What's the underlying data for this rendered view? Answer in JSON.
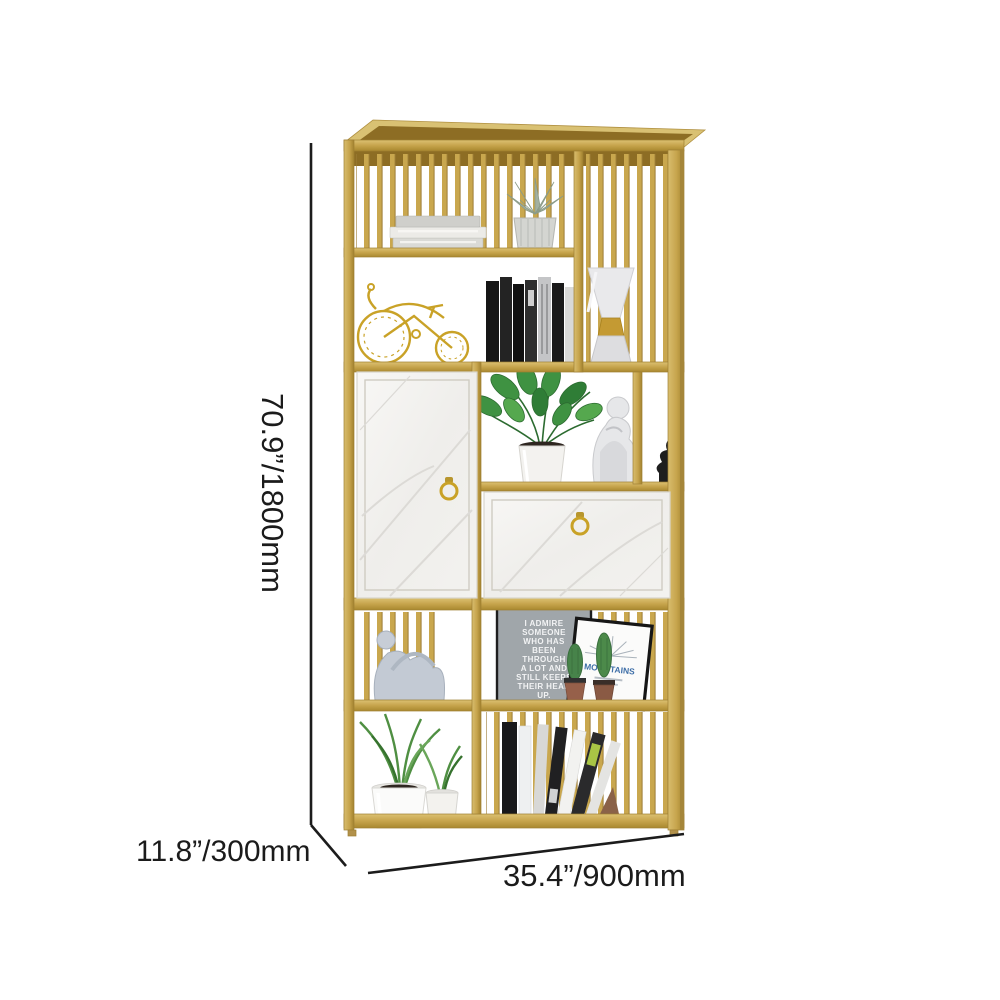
{
  "image": {
    "type": "furniture-dimension-diagram",
    "product_name": "Gold metal etagere bookshelf with white marble cabinet doors",
    "background": "#ffffff"
  },
  "dimensions": {
    "height": "70.9”/1800mm",
    "depth": "11.8”/300mm",
    "width": "35.4”/900mm"
  },
  "decor": {
    "quote_print_lines": [
      "I ADMIRE",
      "SOMEONE",
      "WHO HAS",
      "BEEN",
      "THROUGH",
      "A LOT AND",
      "STILL KEEPS",
      "THEIR HEAD",
      "UP."
    ],
    "mountains_print_text": "MOUNTAINS"
  },
  "colors": {
    "frame_gold": "#c6a44c",
    "frame_gold_dark": "#8d6d24",
    "frame_gold_light": "#dcc172",
    "marble": "#f2f1ee",
    "dimension_line": "#1c1c1c",
    "background": "#ffffff"
  }
}
